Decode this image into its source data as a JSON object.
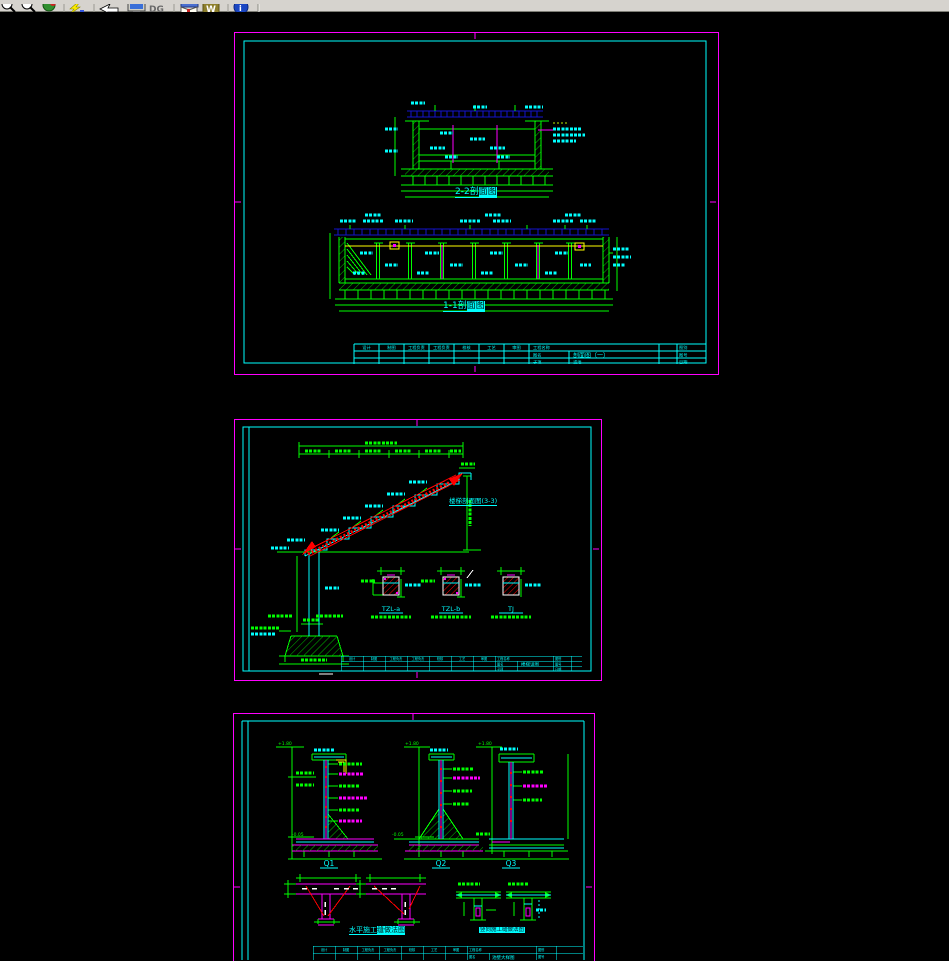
{
  "toolbar": {
    "dg_label": "DG",
    "w_label": "W",
    "info_label": "i",
    "icons": [
      "zoom-in",
      "zoom-out",
      "zoom-extents",
      "regen-lightning",
      "undo-arrow",
      "display-monitor",
      "dg-tool",
      "help-book",
      "word-export",
      "about-info"
    ]
  },
  "titleblock": {
    "cells": [
      "设计",
      "制图",
      "工程负责",
      "工程负责",
      "校核",
      "工艺",
      "审图"
    ],
    "project_label": "工程名称",
    "name_label": "图名",
    "sub_label": "子项",
    "right_labels": [
      "图别",
      "图号",
      "日期"
    ]
  },
  "sheet1": {
    "section2_plain": "2-2剖",
    "section2_sel": "面图",
    "section1_plain": "1-1剖",
    "section1_sel": "面图",
    "drawing_name": "剖面图（一）",
    "sub_name": "滤池"
  },
  "sheet2": {
    "stair_label": "楼梯剖面图(3-3)",
    "details": [
      "TZL-a",
      "TZL-b",
      "TJ"
    ],
    "drawing_name": "楼梯详图"
  },
  "sheet3": {
    "walls": [
      "Q1",
      "Q2",
      "Q3"
    ],
    "elev_top": "+1.80",
    "elev_bottom": "-0.05",
    "caption_left_plain": "水平施工",
    "caption_left_sel": "缝做法图",
    "caption_right": "竖向施工缝做法图",
    "drawing_name": "池壁大样图"
  }
}
